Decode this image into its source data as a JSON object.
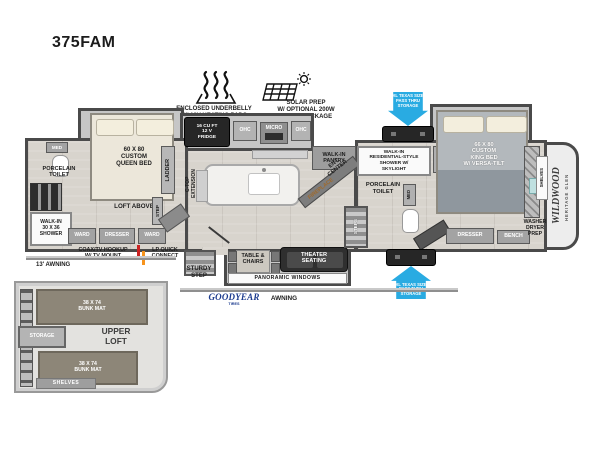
{
  "title": "375FAM",
  "colors": {
    "pass_thru_blue": "#29abe2",
    "goodyear_blue": "#1d3c8f",
    "lp_orange": "#f7941d",
    "coax_red": "#cc2222",
    "wall_gray": "#4a4a4a"
  },
  "callouts": {
    "underbelly": "ENCLOSED UNDERBELLY\nW/ 12V HEATING PADS",
    "solar": "SOLAR PREP\nW/ OPTIONAL 200W\nSOLAR PACKAGE",
    "pass_thru_top": "XL TEXAS SIZE\nPASS THRU\nSTORAGE",
    "pass_thru_bottom": "XL TEXAS SIZE\nPASS THRU\nSTORAGE",
    "coax": "COAX/TV HOOKUP\nW/ TV MOUNT",
    "lp_quick_connect": "LP QUICK\nCONNECT",
    "awning_front": "13' AWNING",
    "awning_main": "AWNING",
    "goodyear": "GOODYEAR",
    "goodyear_sub": "TIRES"
  },
  "front_bedroom": {
    "bed_label": "60 X 80\nCUSTOM\nQUEEN BED",
    "med": "MED",
    "toilet": "PORCELAIN\nTOILET",
    "shower": "WALK-IN\n30 x 36\nSHOWER",
    "ward_left": "WARD",
    "dresser": "DRESSER",
    "ward_right": "WARD",
    "loft_above": "LOFT ABOVE",
    "ladder": "LADDER",
    "step": "STEP"
  },
  "kitchen": {
    "fridge": "16 CU FT\n12 V\nFRIDGE",
    "ohc_left": "OHC",
    "micro": "MICRO",
    "ohc_right": "OHC",
    "island": "C-TOP\nEXTENSION",
    "pantry": "WALK-IN\nPANTRY",
    "ent_center": "ENT\nCENTER",
    "fireplace": "FIREPLACE"
  },
  "living": {
    "table_chairs": "TABLE &\nCHAIRS",
    "theater": "THEATER\nSEATING",
    "panoramic": "PANORAMIC WINDOWS",
    "sturdy_step": "STURDY\nSTEP"
  },
  "rear_bath": {
    "shower": "WALK-IN\nRESIDENTIAL-STYLE\nSHOWER W/\nSKYLIGHT",
    "toilet": "PORCELAIN\nTOILET",
    "med": "MED",
    "steps": "STEPS"
  },
  "rear_bedroom": {
    "bed_label": "66 X 80\nCUSTOM\nKING BED\nW/ VERSA-TILT",
    "dresser": "DRESSER",
    "bench": "BENCH",
    "washer": "WASHER\nDRYER\nPREP",
    "shelves": "SHELVES",
    "brand_line1": "WILDWOOD",
    "brand_line2": "HERITAGE GLEN"
  },
  "loft_inset": {
    "bunk_top": "38 X 74\nBUNK MAT",
    "bunk_bottom": "38 X 74\nBUNK MAT",
    "storage": "STORAGE",
    "upper_loft": "UPPER\nLOFT",
    "shelves": "SHELVES"
  }
}
